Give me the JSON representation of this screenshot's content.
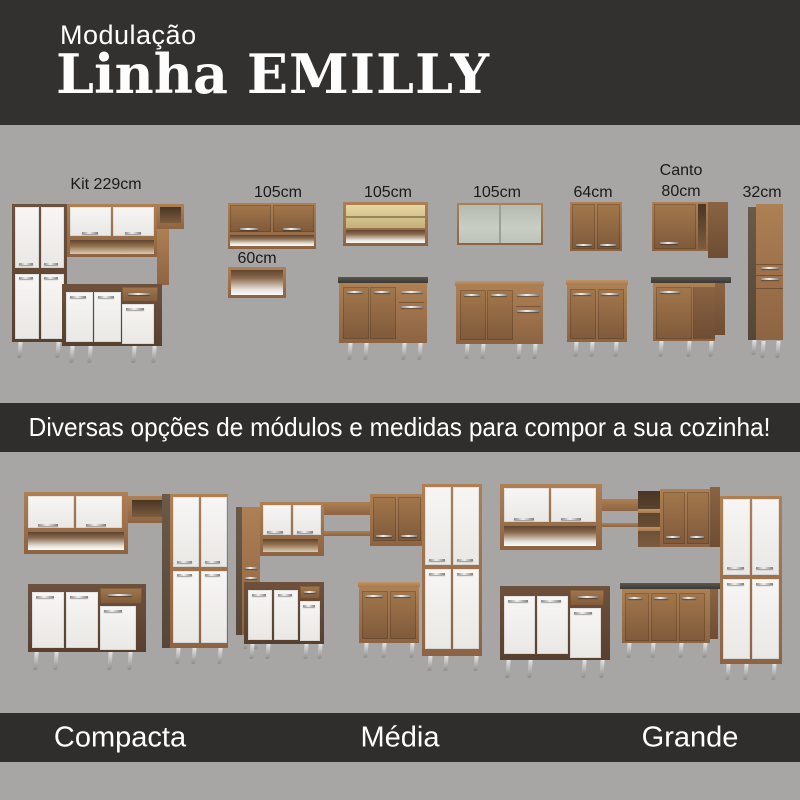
{
  "header": {
    "kicker": "Modulação",
    "title_prefix": "Linha",
    "title_name": "EMILLY"
  },
  "modules": {
    "kit": {
      "label": "Kit 229cm"
    },
    "wall_105": {
      "label": "105cm"
    },
    "open_105": {
      "label": "105cm"
    },
    "glass_105": {
      "label": "105cm"
    },
    "wall_64": {
      "label": "64cm"
    },
    "canto_80": {
      "line1": "Canto",
      "line2": "80cm"
    },
    "tall_32": {
      "label": "32cm"
    },
    "niche_60": {
      "label": "60cm"
    }
  },
  "banner": {
    "text": "Diversas opções de módulos e medidas para compor a sua cozinha!"
  },
  "footer": {
    "options": [
      "Compacta",
      "Média",
      "Grande"
    ]
  },
  "colors": {
    "background_gray": "#a8a6a4",
    "band_dark": "#2f2e2c",
    "wood": "#9a7149",
    "door_white": "#f4f3f1",
    "text_light": "#ffffff",
    "text_dark": "#1a1a1a"
  }
}
